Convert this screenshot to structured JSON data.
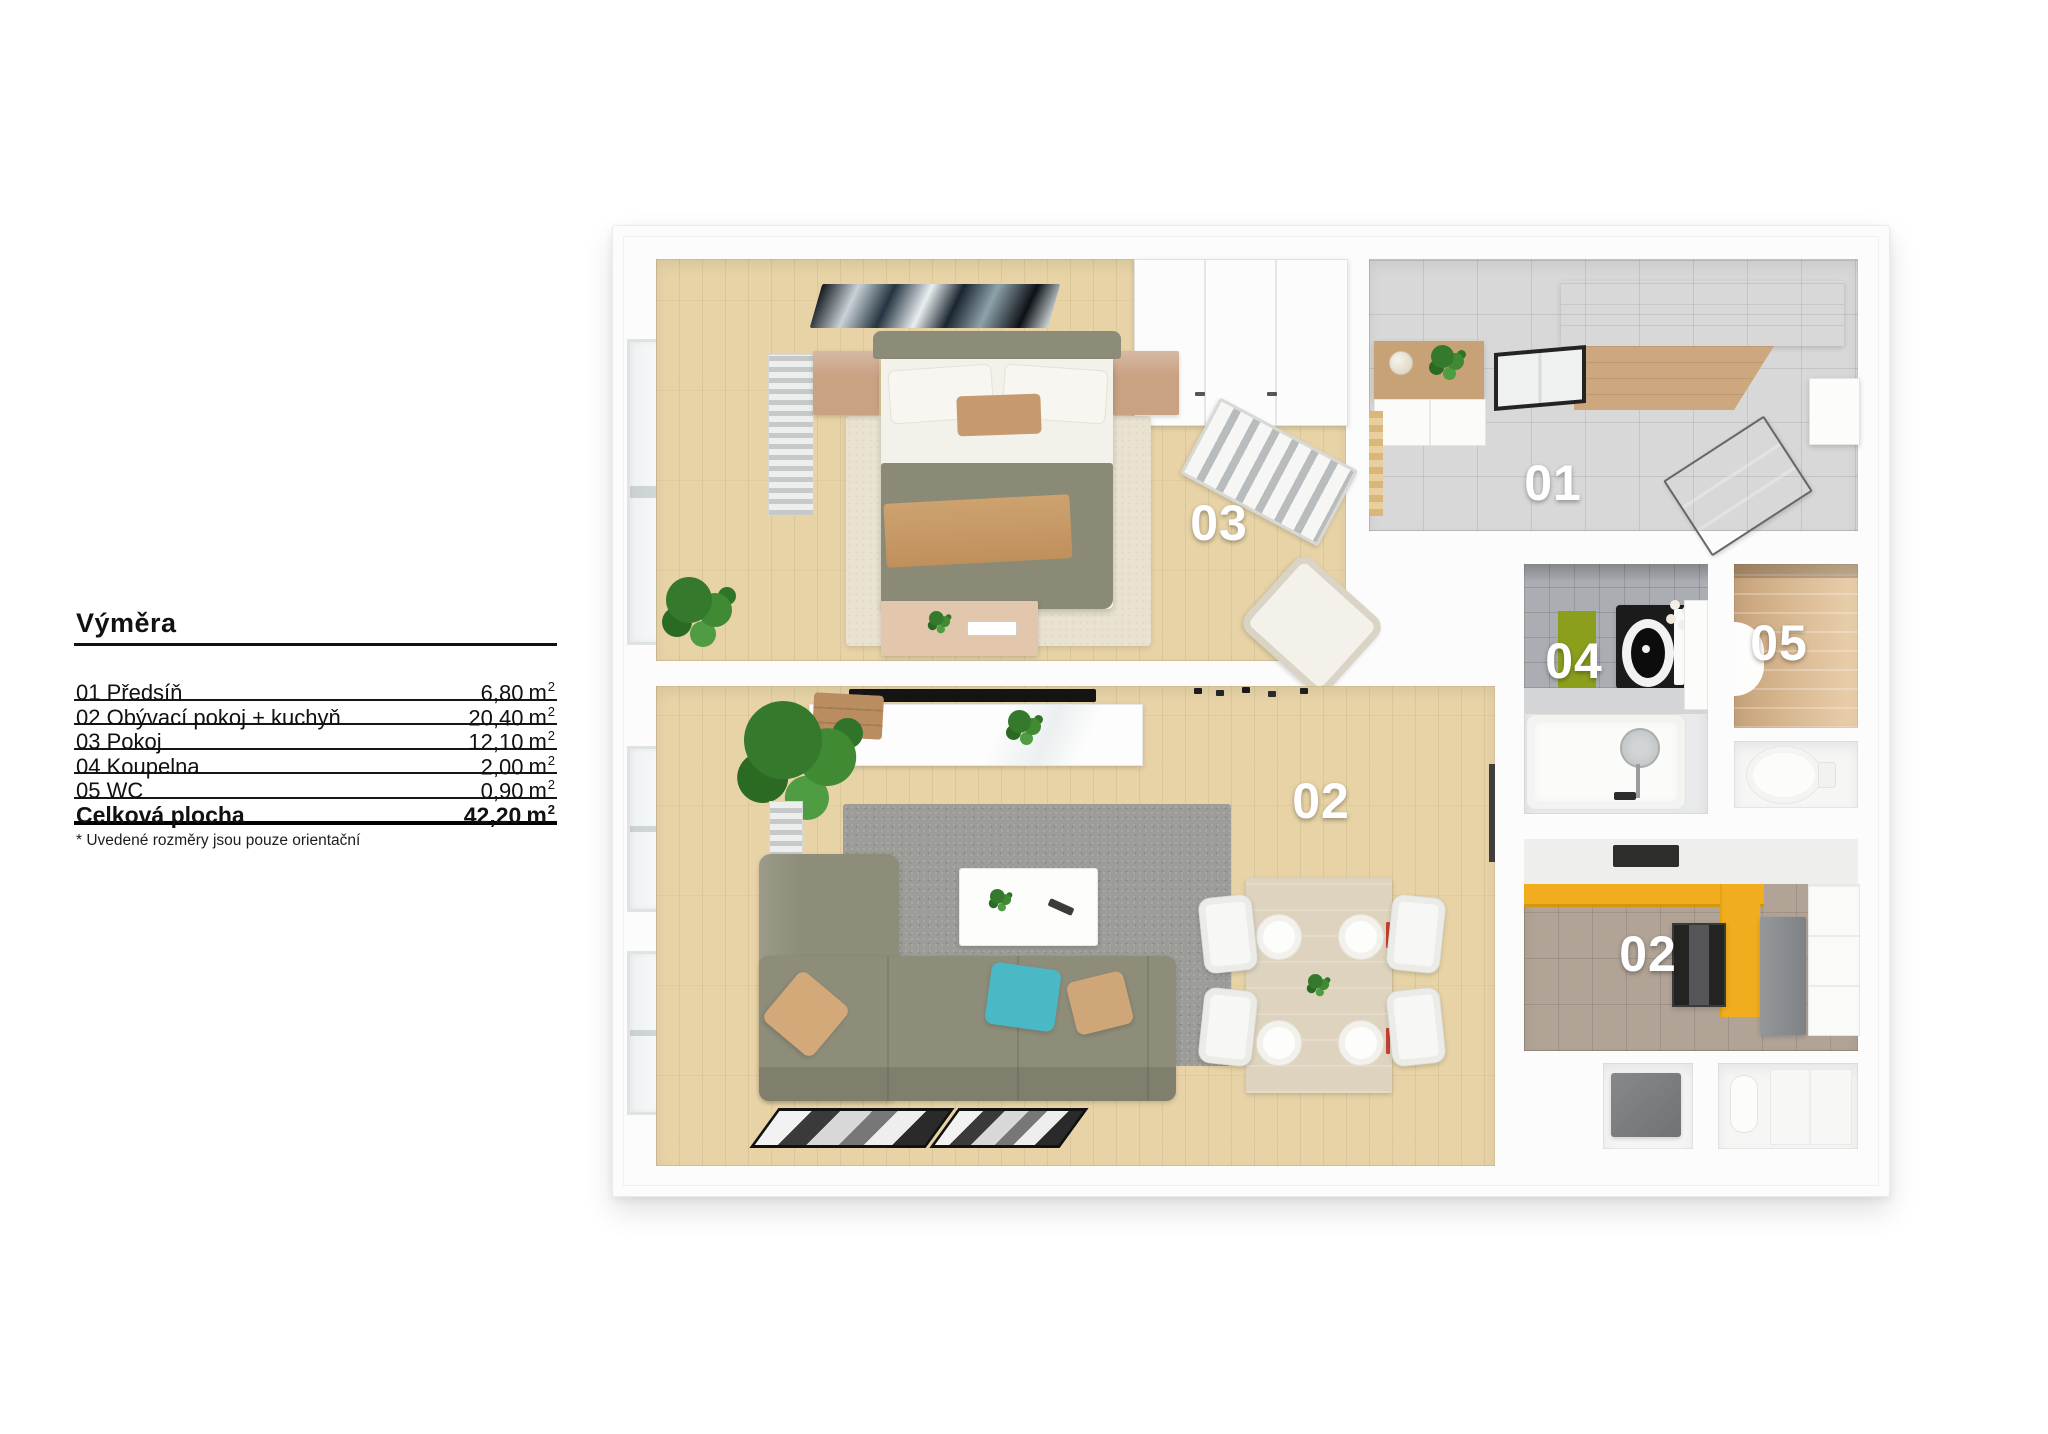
{
  "legend": {
    "title": "Výměra",
    "rows": [
      {
        "label": "01 Předsíň",
        "area": "6,80",
        "unit": "m",
        "exp": "2"
      },
      {
        "label": "02 Obývací pokoj + kuchyň",
        "area": "20,40",
        "unit": "m",
        "exp": "2"
      },
      {
        "label": "03 Pokoj",
        "area": "12,10",
        "unit": "m",
        "exp": "2"
      },
      {
        "label": "04 Koupelna",
        "area": "2,00",
        "unit": "m",
        "exp": "2"
      },
      {
        "label": "05 WC",
        "area": "0,90",
        "unit": "m",
        "exp": "2"
      }
    ],
    "total": {
      "label": "Celková plocha",
      "area": "42,20",
      "unit": "m",
      "exp": "2"
    },
    "footnote": "* Uvedené rozměry jsou pouze orientační"
  },
  "plan": {
    "labels": {
      "hall": "01",
      "living": "02",
      "kitchen": "02",
      "bedroom": "03",
      "bath": "04",
      "wc": "05"
    }
  },
  "colors": {
    "counter_yellow": "#f1ad1e",
    "sofa_olive": "#8e8d7a",
    "bed_olive": "#8a8a76",
    "pillow_teal": "#4ab8c5",
    "pillow_beige": "#d4a97a",
    "bath_mat_green": "#8c9f1d",
    "floor_wood": "#e7d3a6",
    "floor_tile_gray": "#d8d8d8",
    "floor_tile_taupe": "#b1a396",
    "wood_furniture": "#cda77e",
    "rug_gray": "#9c9c98",
    "rug_cream": "#e9e2d1",
    "wc_wall_tan": "#dcbd97"
  }
}
